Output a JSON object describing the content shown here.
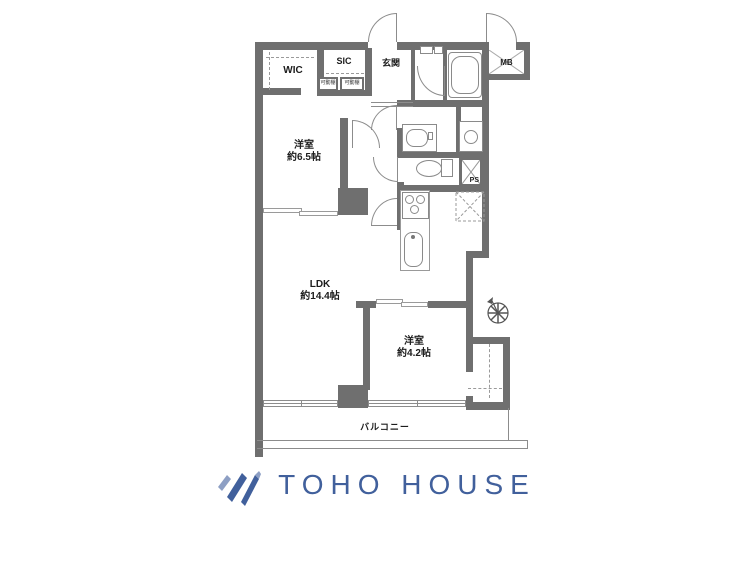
{
  "plan": {
    "wic": {
      "label": "WIC"
    },
    "sic": {
      "label": "SIC"
    },
    "genkan": {
      "label": "玄関"
    },
    "mb": {
      "label": "MB"
    },
    "ps": {
      "label": "PS"
    },
    "shelf_left": {
      "label": "可動棚"
    },
    "shelf_right": {
      "label": "可動棚"
    },
    "bedroom1": {
      "name": "洋室",
      "size": "約6.5帖"
    },
    "ldk": {
      "name": "LDK",
      "size": "約14.4帖"
    },
    "bedroom2": {
      "name": "洋室",
      "size": "約4.2帖"
    },
    "balcony": {
      "label": "バルコニー"
    }
  },
  "footer": {
    "brand": "TOHO HOUSE"
  },
  "colors": {
    "wall": "#6f6f6f",
    "line": "#8c8c8c",
    "text": "#1c1c1c",
    "logo": "#41609c",
    "logo_light": "#8d9fc4"
  }
}
